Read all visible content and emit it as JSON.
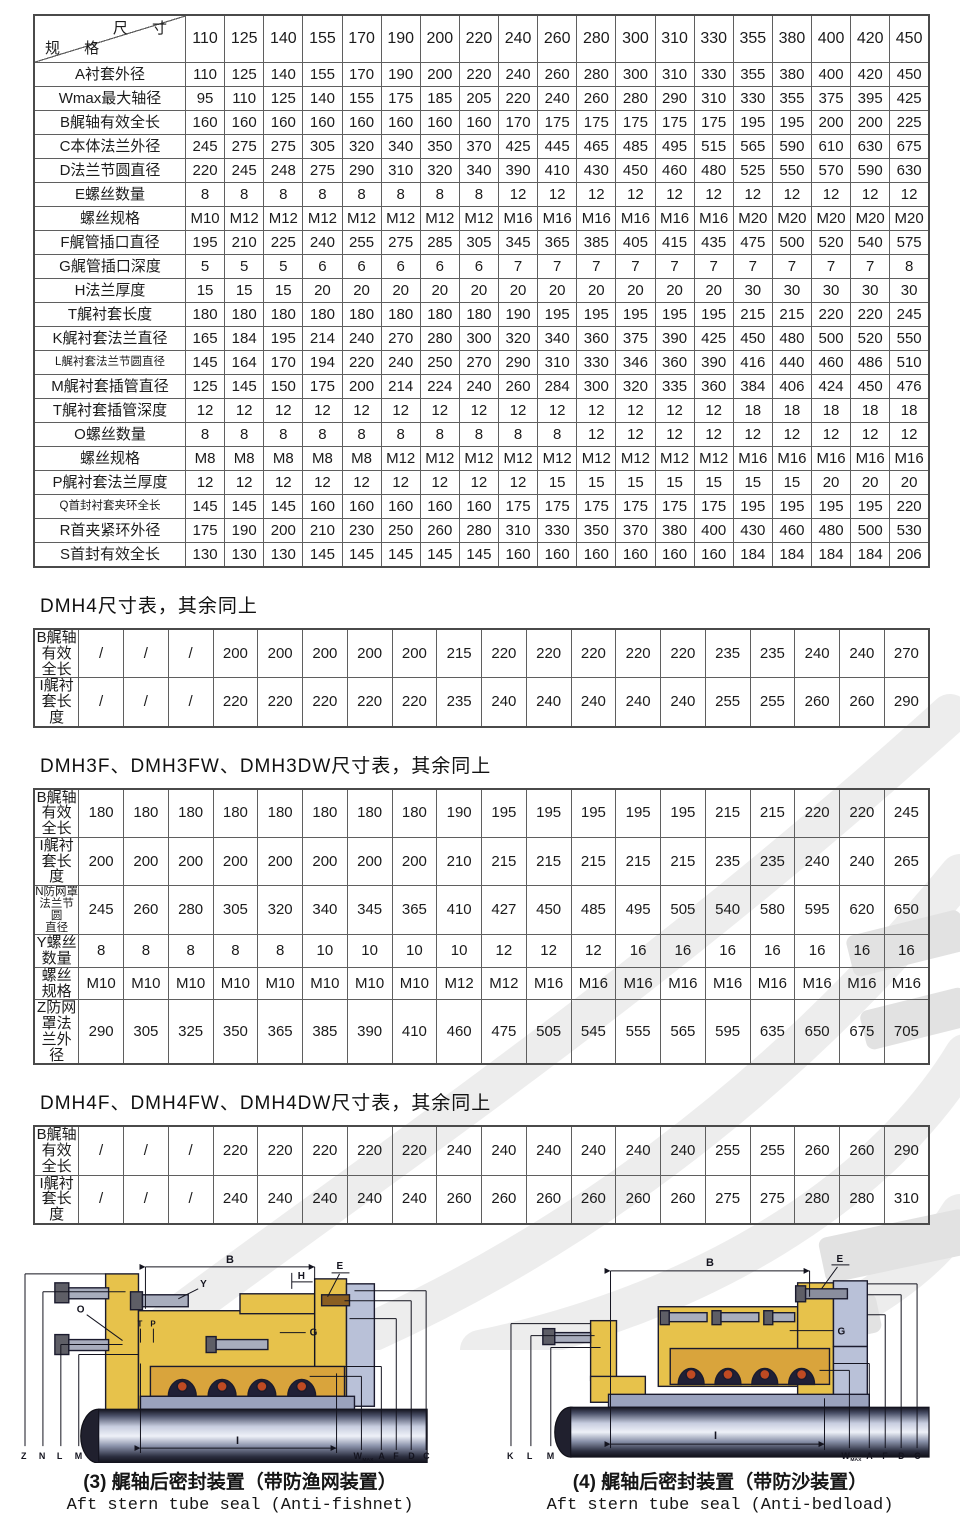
{
  "main_table": {
    "corner_top": "尺 寸",
    "corner_bottom": "规 格",
    "columns": [
      "110",
      "125",
      "140",
      "155",
      "170",
      "190",
      "200",
      "220",
      "240",
      "260",
      "280",
      "300",
      "310",
      "330",
      "355",
      "380",
      "400",
      "420",
      "450"
    ],
    "rows": [
      {
        "label": "A衬套外径",
        "values": [
          "110",
          "125",
          "140",
          "155",
          "170",
          "190",
          "200",
          "220",
          "240",
          "260",
          "280",
          "300",
          "310",
          "330",
          "355",
          "380",
          "400",
          "420",
          "450"
        ]
      },
      {
        "label": "Wmax最大轴径",
        "values": [
          "95",
          "110",
          "125",
          "140",
          "155",
          "175",
          "185",
          "205",
          "220",
          "240",
          "260",
          "280",
          "290",
          "310",
          "330",
          "355",
          "375",
          "395",
          "425"
        ]
      },
      {
        "label": "B艉轴有效全长",
        "values": [
          "160",
          "160",
          "160",
          "160",
          "160",
          "160",
          "160",
          "160",
          "170",
          "175",
          "175",
          "175",
          "175",
          "175",
          "195",
          "195",
          "200",
          "200",
          "225"
        ]
      },
      {
        "label": "C本体法兰外径",
        "values": [
          "245",
          "275",
          "275",
          "305",
          "320",
          "340",
          "350",
          "370",
          "425",
          "445",
          "465",
          "485",
          "495",
          "515",
          "565",
          "590",
          "610",
          "630",
          "675"
        ]
      },
      {
        "label": "D法兰节圆直径",
        "values": [
          "220",
          "245",
          "248",
          "275",
          "290",
          "310",
          "320",
          "340",
          "390",
          "410",
          "430",
          "450",
          "460",
          "480",
          "525",
          "550",
          "570",
          "590",
          "630"
        ]
      },
      {
        "label": "E螺丝数量",
        "values": [
          "8",
          "8",
          "8",
          "8",
          "8",
          "8",
          "8",
          "8",
          "12",
          "12",
          "12",
          "12",
          "12",
          "12",
          "12",
          "12",
          "12",
          "12",
          "12"
        ]
      },
      {
        "label": "螺丝规格",
        "values": [
          "M10",
          "M12",
          "M12",
          "M12",
          "M12",
          "M12",
          "M12",
          "M12",
          "M16",
          "M16",
          "M16",
          "M16",
          "M16",
          "M16",
          "M20",
          "M20",
          "M20",
          "M20",
          "M20"
        ]
      },
      {
        "label": "F艉管插口直径",
        "values": [
          "195",
          "210",
          "225",
          "240",
          "255",
          "275",
          "285",
          "305",
          "345",
          "365",
          "385",
          "405",
          "415",
          "435",
          "475",
          "500",
          "520",
          "540",
          "575"
        ]
      },
      {
        "label": "G艉管插口深度",
        "values": [
          "5",
          "5",
          "5",
          "6",
          "6",
          "6",
          "6",
          "6",
          "7",
          "7",
          "7",
          "7",
          "7",
          "7",
          "7",
          "7",
          "7",
          "7",
          "8"
        ]
      },
      {
        "label": "H法兰厚度",
        "values": [
          "15",
          "15",
          "15",
          "20",
          "20",
          "20",
          "20",
          "20",
          "20",
          "20",
          "20",
          "20",
          "20",
          "20",
          "30",
          "30",
          "30",
          "30",
          "30"
        ]
      },
      {
        "label": "T艉衬套长度",
        "values": [
          "180",
          "180",
          "180",
          "180",
          "180",
          "180",
          "180",
          "180",
          "190",
          "195",
          "195",
          "195",
          "195",
          "195",
          "215",
          "215",
          "220",
          "220",
          "245"
        ]
      },
      {
        "label": "K艉衬套法兰直径",
        "values": [
          "165",
          "184",
          "195",
          "214",
          "240",
          "270",
          "280",
          "300",
          "320",
          "340",
          "360",
          "375",
          "390",
          "425",
          "450",
          "480",
          "500",
          "520",
          "550"
        ]
      },
      {
        "label": "L艉衬套法兰节圆直径",
        "values": [
          "145",
          "164",
          "170",
          "194",
          "220",
          "240",
          "250",
          "270",
          "290",
          "310",
          "330",
          "346",
          "360",
          "390",
          "416",
          "440",
          "460",
          "486",
          "510"
        ]
      },
      {
        "label": "M艉衬套插管直径",
        "values": [
          "125",
          "145",
          "150",
          "175",
          "200",
          "214",
          "224",
          "240",
          "260",
          "284",
          "300",
          "320",
          "335",
          "360",
          "384",
          "406",
          "424",
          "450",
          "476"
        ]
      },
      {
        "label": "T艉衬套插管深度",
        "values": [
          "12",
          "12",
          "12",
          "12",
          "12",
          "12",
          "12",
          "12",
          "12",
          "12",
          "12",
          "12",
          "12",
          "12",
          "18",
          "18",
          "18",
          "18",
          "18"
        ]
      },
      {
        "label": "O螺丝数量",
        "values": [
          "8",
          "8",
          "8",
          "8",
          "8",
          "8",
          "8",
          "8",
          "8",
          "8",
          "12",
          "12",
          "12",
          "12",
          "12",
          "12",
          "12",
          "12",
          "12"
        ]
      },
      {
        "label": "螺丝规格",
        "values": [
          "M8",
          "M8",
          "M8",
          "M8",
          "M8",
          "M12",
          "M12",
          "M12",
          "M12",
          "M12",
          "M12",
          "M12",
          "M12",
          "M12",
          "M16",
          "M16",
          "M16",
          "M16",
          "M16"
        ]
      },
      {
        "label": "P艉衬套法兰厚度",
        "values": [
          "12",
          "12",
          "12",
          "12",
          "12",
          "12",
          "12",
          "12",
          "12",
          "15",
          "15",
          "15",
          "15",
          "15",
          "15",
          "15",
          "20",
          "20",
          "20"
        ]
      },
      {
        "label": "Q首封衬套夹环全长",
        "values": [
          "145",
          "145",
          "145",
          "160",
          "160",
          "160",
          "160",
          "160",
          "175",
          "175",
          "175",
          "175",
          "175",
          "175",
          "195",
          "195",
          "195",
          "195",
          "220"
        ]
      },
      {
        "label": "R首夹紧环外径",
        "values": [
          "175",
          "190",
          "200",
          "210",
          "230",
          "250",
          "260",
          "280",
          "310",
          "330",
          "350",
          "370",
          "380",
          "400",
          "430",
          "460",
          "480",
          "500",
          "530"
        ]
      },
      {
        "label": "S首封有效全长",
        "values": [
          "130",
          "130",
          "130",
          "145",
          "145",
          "145",
          "145",
          "145",
          "160",
          "160",
          "160",
          "160",
          "160",
          "160",
          "184",
          "184",
          "184",
          "184",
          "206"
        ]
      }
    ]
  },
  "section_dmh4": {
    "title": "DMH4尺寸表，其余同上",
    "rows": [
      {
        "label": "B艉轴有效全长",
        "values": [
          "/",
          "/",
          "/",
          "200",
          "200",
          "200",
          "200",
          "200",
          "215",
          "220",
          "220",
          "220",
          "220",
          "220",
          "235",
          "235",
          "240",
          "240",
          "270"
        ]
      },
      {
        "label": "I艉衬套长度",
        "values": [
          "/",
          "/",
          "/",
          "220",
          "220",
          "220",
          "220",
          "220",
          "235",
          "240",
          "240",
          "240",
          "240",
          "240",
          "255",
          "255",
          "260",
          "260",
          "290"
        ]
      }
    ]
  },
  "section_dmh3f": {
    "title": "DMH3F、DMH3FW、DMH3DW尺寸表，其余同上",
    "rows": [
      {
        "label": "B艉轴有效全长",
        "values": [
          "180",
          "180",
          "180",
          "180",
          "180",
          "180",
          "180",
          "180",
          "190",
          "195",
          "195",
          "195",
          "195",
          "195",
          "215",
          "215",
          "220",
          "220",
          "245"
        ]
      },
      {
        "label": "I艉衬套长度",
        "values": [
          "200",
          "200",
          "200",
          "200",
          "200",
          "200",
          "200",
          "200",
          "210",
          "215",
          "215",
          "215",
          "215",
          "215",
          "235",
          "235",
          "240",
          "240",
          "265"
        ]
      },
      {
        "label": "N防网罩法兰节圆\n直径",
        "values": [
          "245",
          "260",
          "280",
          "305",
          "320",
          "340",
          "345",
          "365",
          "410",
          "427",
          "450",
          "485",
          "495",
          "505",
          "540",
          "580",
          "595",
          "620",
          "650"
        ]
      },
      {
        "label": "Y螺丝数量",
        "values": [
          "8",
          "8",
          "8",
          "8",
          "8",
          "10",
          "10",
          "10",
          "10",
          "12",
          "12",
          "12",
          "16",
          "16",
          "16",
          "16",
          "16",
          "16",
          "16"
        ]
      },
      {
        "label": "螺丝规格",
        "values": [
          "M10",
          "M10",
          "M10",
          "M10",
          "M10",
          "M10",
          "M10",
          "M10",
          "M12",
          "M12",
          "M16",
          "M16",
          "M16",
          "M16",
          "M16",
          "M16",
          "M16",
          "M16",
          "M16"
        ]
      },
      {
        "label": "Z防网罩法兰外径",
        "values": [
          "290",
          "305",
          "325",
          "350",
          "365",
          "385",
          "390",
          "410",
          "460",
          "475",
          "505",
          "545",
          "555",
          "565",
          "595",
          "635",
          "650",
          "675",
          "705"
        ]
      }
    ]
  },
  "section_dmh4f": {
    "title": "DMH4F、DMH4FW、DMH4DW尺寸表，其余同上",
    "rows": [
      {
        "label": "B艉轴有效全长",
        "values": [
          "/",
          "/",
          "/",
          "220",
          "220",
          "220",
          "220",
          "220",
          "240",
          "240",
          "240",
          "240",
          "240",
          "240",
          "255",
          "255",
          "260",
          "260",
          "290"
        ]
      },
      {
        "label": "I艉衬套长度",
        "values": [
          "/",
          "/",
          "/",
          "240",
          "240",
          "240",
          "240",
          "240",
          "260",
          "260",
          "260",
          "260",
          "260",
          "260",
          "275",
          "275",
          "280",
          "280",
          "310"
        ]
      }
    ]
  },
  "figures": [
    {
      "caption_zh": "(3) 艉轴后密封装置（带防渔网装置）",
      "caption_en": "Aft stern tube seal (Anti-fishnet)",
      "labels": {
        "b": "B",
        "h": "H",
        "e": "E",
        "y": "Y",
        "o": "O",
        "t": "T",
        "p": "P",
        "g": "G",
        "i": "I",
        "z": "Z",
        "n": "N",
        "l": "L",
        "m": "M",
        "w": "W",
        "wmax": "MAX",
        "a": "A",
        "f": "F",
        "d": "D",
        "c": "C"
      }
    },
    {
      "caption_zh": "(4) 艉轴后密封装置（带防沙装置）",
      "caption_en": "Aft stern tube seal (Anti-bedload)",
      "labels": {
        "b": "B",
        "e": "E",
        "g": "G",
        "i": "I",
        "k": "K",
        "l": "L",
        "m": "M",
        "w": "W",
        "wmax": "MAX",
        "a": "A",
        "f": "F",
        "d": "D",
        "c": "C"
      }
    }
  ],
  "colors": {
    "body_yellow": "#e7c24b",
    "metal_gray": "#b9c1d8",
    "seal_red": "#bf4a22",
    "outline_navy": "#1b1b2e"
  }
}
